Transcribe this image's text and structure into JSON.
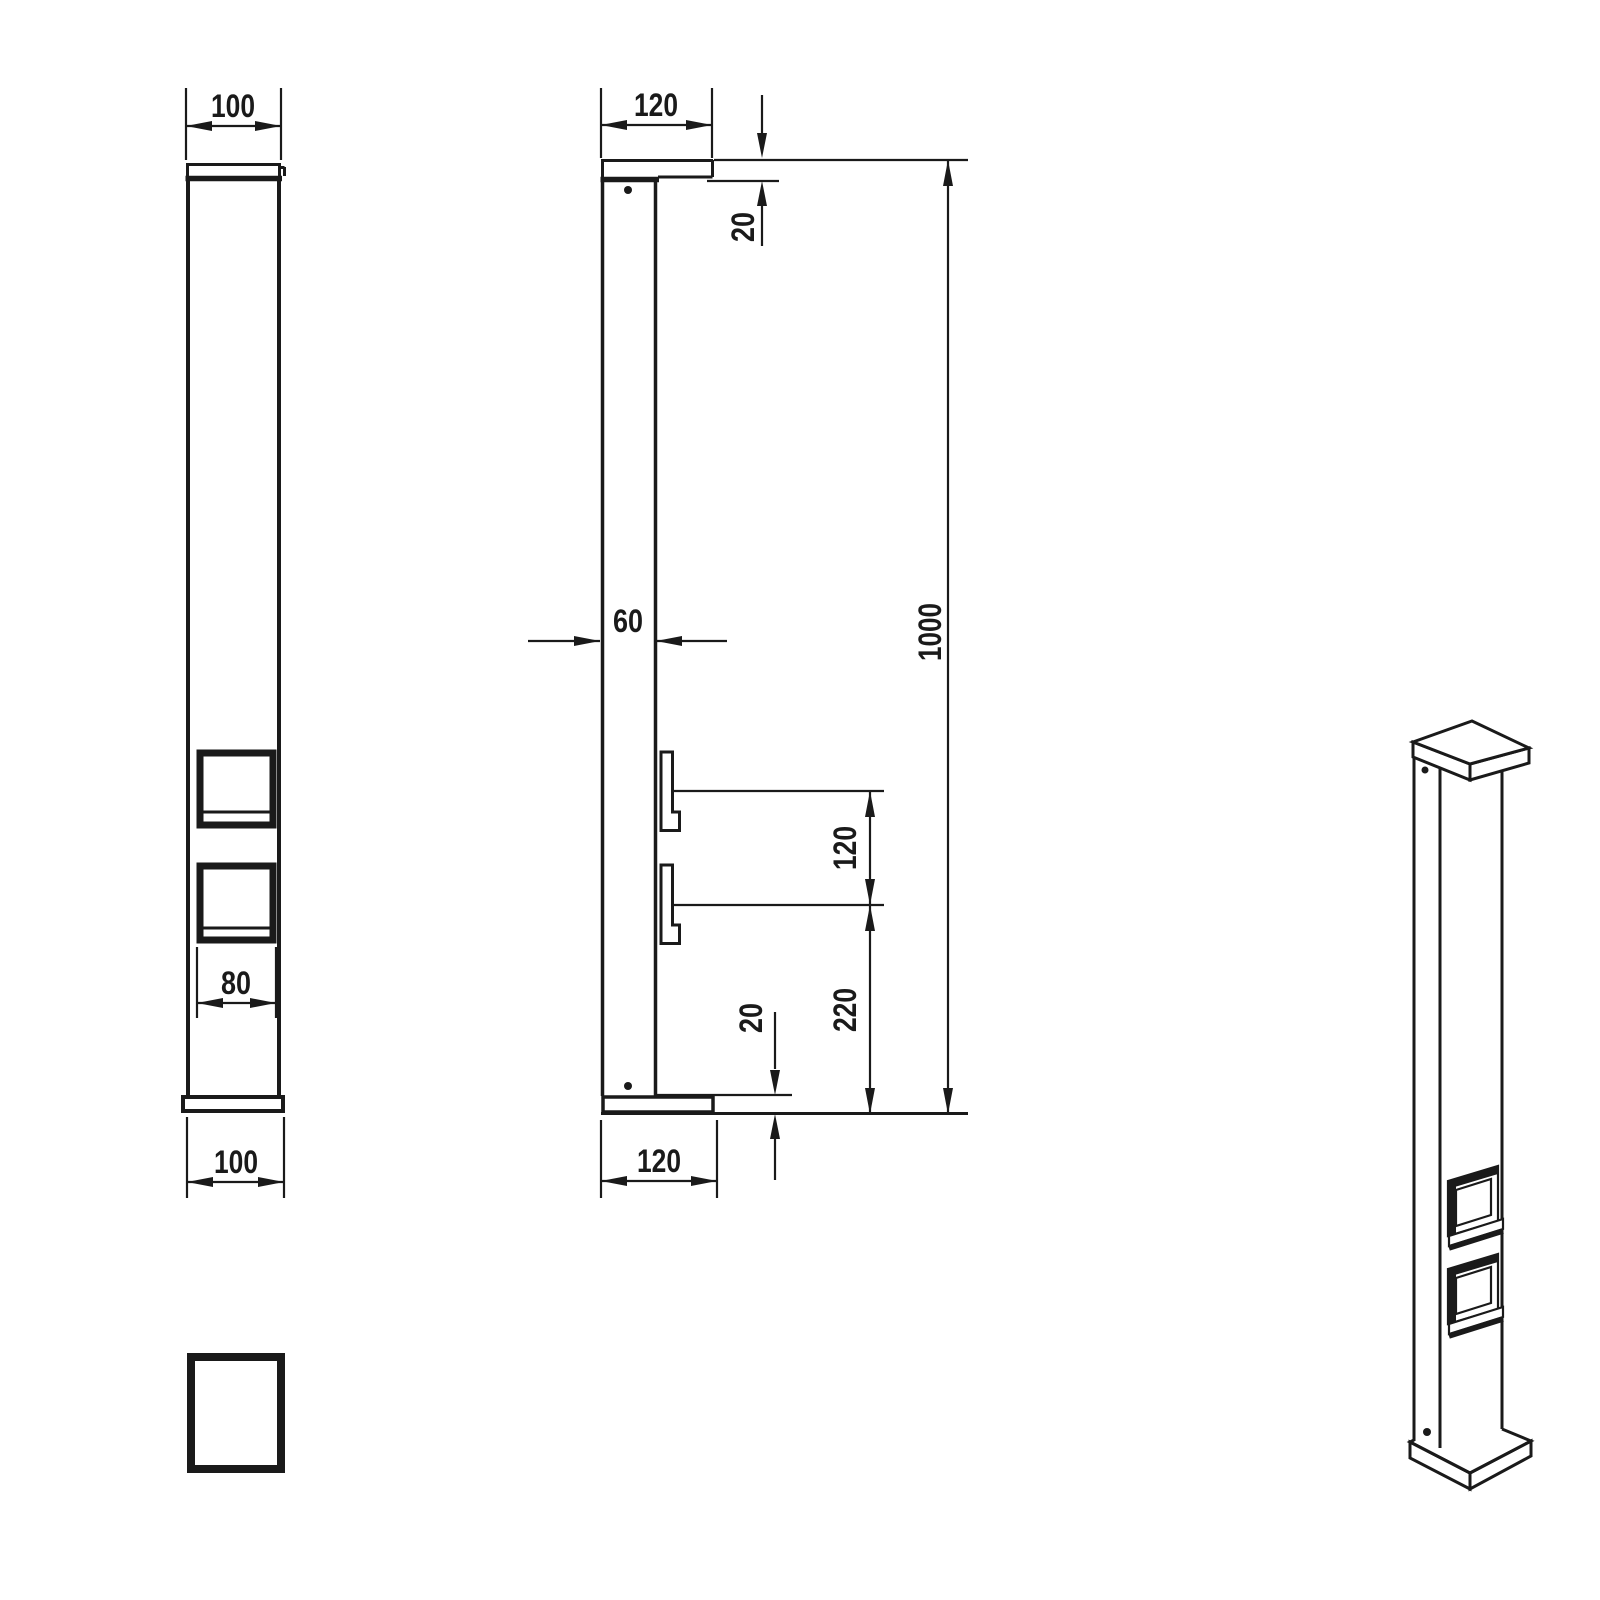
{
  "drawing": {
    "colors": {
      "line": "#1a1a1a",
      "background": "#ffffff"
    },
    "front_view": {
      "top_width": "100",
      "socket_width": "80",
      "bottom_width": "100"
    },
    "side_view": {
      "top_width": "120",
      "cap_thickness": "20",
      "body_depth": "60",
      "total_height": "1000",
      "socket_spacing": "120",
      "lower_socket_center_height": "220",
      "base_thickness": "20",
      "bottom_width": "120"
    }
  }
}
